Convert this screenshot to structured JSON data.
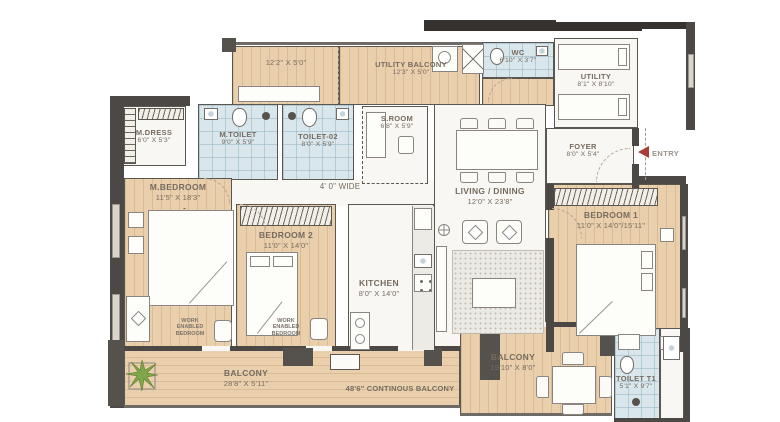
{
  "meta": {
    "type": "apartment-floor-plan"
  },
  "colors": {
    "wood_floor": "#e9cfac",
    "tile_floor": "#d9e7ec",
    "room_floor": "#f8f7f3",
    "wall_dark": "#4c4845",
    "wall_black": "#35322f",
    "label_text": "#766b60",
    "entry_red": "#a83e37",
    "plant_green": "#7fa648"
  },
  "rooms": {
    "balcony_top": {
      "dims": "12'2\" X 5'0\""
    },
    "utility_balcony": {
      "name": "UTILITY BALCONY",
      "dims": "12'3\" X 5'0\""
    },
    "wc": {
      "name": "WC",
      "dims": "6'10\" X 3'7\""
    },
    "utility": {
      "name": "UTILITY",
      "dims": "8'1\" X 8'10\""
    },
    "m_dress": {
      "name": "M.DRESS",
      "dims": "6'0\" X 5'3\""
    },
    "m_toilet": {
      "name": "M.TOILET",
      "dims": "9'0\" X 5'9\""
    },
    "toilet_02": {
      "name": "TOILET-02",
      "dims": "8'0\" X 5'9\""
    },
    "s_room": {
      "name": "S.ROOM",
      "dims": "6'8\" X 5'9\""
    },
    "foyer": {
      "name": "FOYER",
      "dims": "8'0\" X 5'4\""
    },
    "entry": {
      "label": "ENTRY"
    },
    "corridor": {
      "label": "4' 0\" WIDE"
    },
    "m_bedroom": {
      "name": "M.BEDROOM",
      "dims": "11'5\" X 18'3\"",
      "note": "WORK ENABLED BEDROOM"
    },
    "bedroom_2": {
      "name": "BEDROOM 2",
      "dims": "11'0\" X 14'0\"",
      "note": "WORK ENABLED BEDROOM"
    },
    "kitchen": {
      "name": "KITCHEN",
      "dims": "8'0\" X 14'0\""
    },
    "living_dining": {
      "name": "LIVING / DINING",
      "dims": "12'0\" X 23'8\""
    },
    "bedroom_1": {
      "name": "BEDROOM 1",
      "dims": "11'0\" X 14'0\"/15'11\""
    },
    "balcony_main": {
      "name": "BALCONY",
      "dims": "28'8\" X 5'11\""
    },
    "continuous_balcony": {
      "label": "48'6\" CONTINOUS BALCONY"
    },
    "balcony_right": {
      "name": "BALCONY",
      "dims": "19'10\" X 8'0\""
    },
    "toilet_t1": {
      "name": "TOILET T1",
      "dims": "5'1\" X 9'7\""
    }
  }
}
